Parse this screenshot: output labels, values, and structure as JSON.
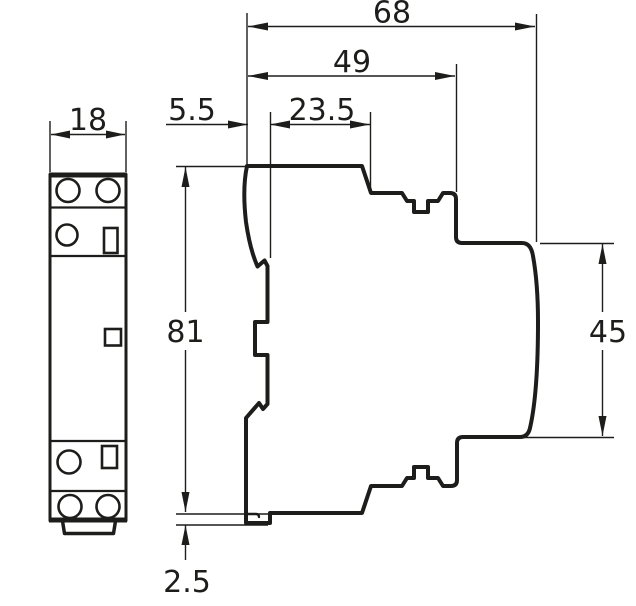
{
  "drawing": {
    "kind": "technical-dimension-drawing",
    "background_color": "#ffffff",
    "line_color": "#1d1d1b",
    "labels": {
      "front_width": "18",
      "overall_depth": "68",
      "upper_depth": "49",
      "rail_offset": "5.5",
      "mid_depth": "23.5",
      "overall_height": "81",
      "front_face_height": "45",
      "bottom_offset": "2.5"
    }
  }
}
